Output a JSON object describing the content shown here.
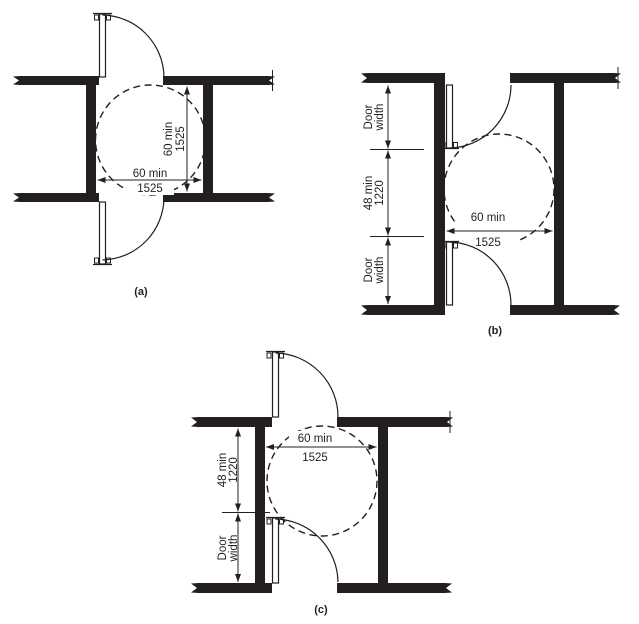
{
  "colors": {
    "ink": "#231f20",
    "paper": "#ffffff"
  },
  "figures": {
    "a": {
      "caption": "(a)",
      "dim_vertical": {
        "label": "60 min",
        "value": "1525"
      },
      "dim_horizontal": {
        "label": "60 min",
        "value": "1525"
      }
    },
    "b": {
      "caption": "(b)",
      "dim_door_width_top": {
        "line1": "Door",
        "line2": "width"
      },
      "dim_between": {
        "label": "48 min",
        "value": "1220"
      },
      "dim_door_width_bottom": {
        "line1": "Door",
        "line2": "width"
      },
      "dim_horizontal": {
        "label": "60 min",
        "value": "1525"
      }
    },
    "c": {
      "caption": "(c)",
      "dim_between": {
        "label": "48 min",
        "value": "1220"
      },
      "dim_door_width": {
        "line1": "Door",
        "line2": "width"
      },
      "dim_horizontal": {
        "label": "60 min",
        "value": "1525"
      }
    }
  }
}
